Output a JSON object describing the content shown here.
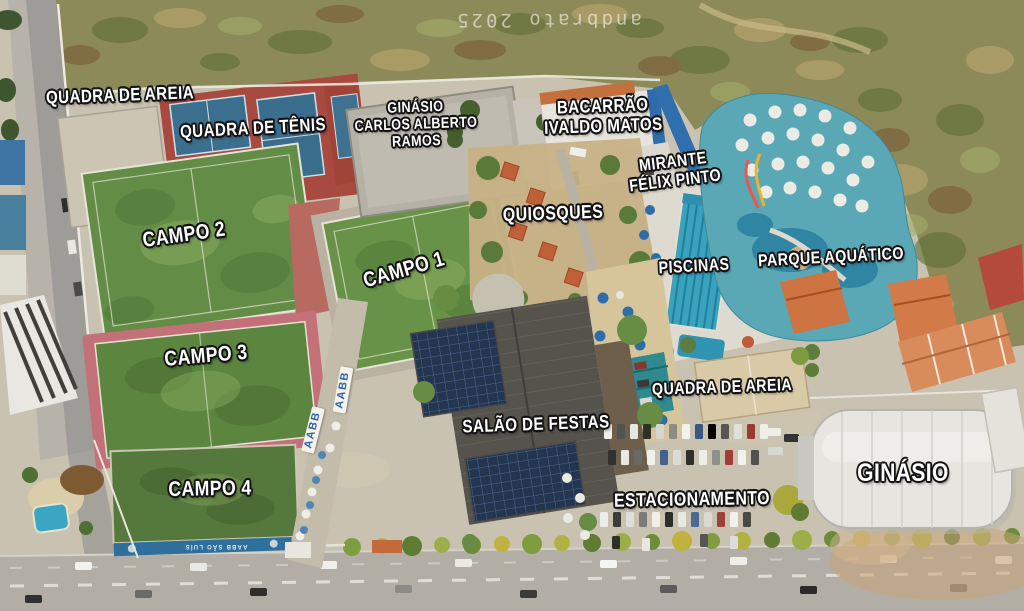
{
  "image_type": "aerial-photo-map",
  "watermark": {
    "text": "andbrato 2025"
  },
  "club": {
    "road_banner_text": "AABB",
    "stand_text": "AABB SÃO LUÍS"
  },
  "labels": [
    {
      "id": "quadra-de-areia-top",
      "lines": [
        "QUADRA DE AREIA"
      ]
    },
    {
      "id": "quadra-de-tenis",
      "lines": [
        "QUADRA DE TÊNIS"
      ]
    },
    {
      "id": "ginasio-carlos-alberto-ramos",
      "lines": [
        "GINÁSIO",
        "CARLOS ALBERTO",
        "RAMOS"
      ]
    },
    {
      "id": "bacarrao-ivaldo-matos",
      "lines": [
        "BACARRÃO",
        "IVALDO MATOS"
      ]
    },
    {
      "id": "mirante-felix-pinto",
      "lines": [
        "MIRANTE",
        "FÉLIX PINTO"
      ]
    },
    {
      "id": "quiosques",
      "lines": [
        "QUIOSQUES"
      ]
    },
    {
      "id": "campo-1",
      "lines": [
        "CAMPO 1"
      ]
    },
    {
      "id": "campo-2",
      "lines": [
        "CAMPO 2"
      ]
    },
    {
      "id": "campo-3",
      "lines": [
        "CAMPO 3"
      ]
    },
    {
      "id": "campo-4",
      "lines": [
        "CAMPO 4"
      ]
    },
    {
      "id": "piscinas",
      "lines": [
        "PISCINAS"
      ]
    },
    {
      "id": "parque-aquatico",
      "lines": [
        "PARQUE AQUÁTICO"
      ]
    },
    {
      "id": "quadra-de-areia-center",
      "lines": [
        "QUADRA DE AREIA"
      ]
    },
    {
      "id": "salao-de-festas",
      "lines": [
        "SALÃO DE FESTAS"
      ]
    },
    {
      "id": "estacionamento",
      "lines": [
        "ESTACIONAMENTO"
      ]
    },
    {
      "id": "ginasio",
      "lines": [
        "GINÁSIO"
      ]
    }
  ],
  "colors": {
    "label_text": "#ffffff",
    "label_outline": "#141414",
    "field_green": "#638c46",
    "pool_teal": "#5aa8b6",
    "tennis_red": "#a84a40",
    "court_blue": "#3c6f8e",
    "sand": "#c9c2b0",
    "banner_blue": "#2f66a8"
  }
}
